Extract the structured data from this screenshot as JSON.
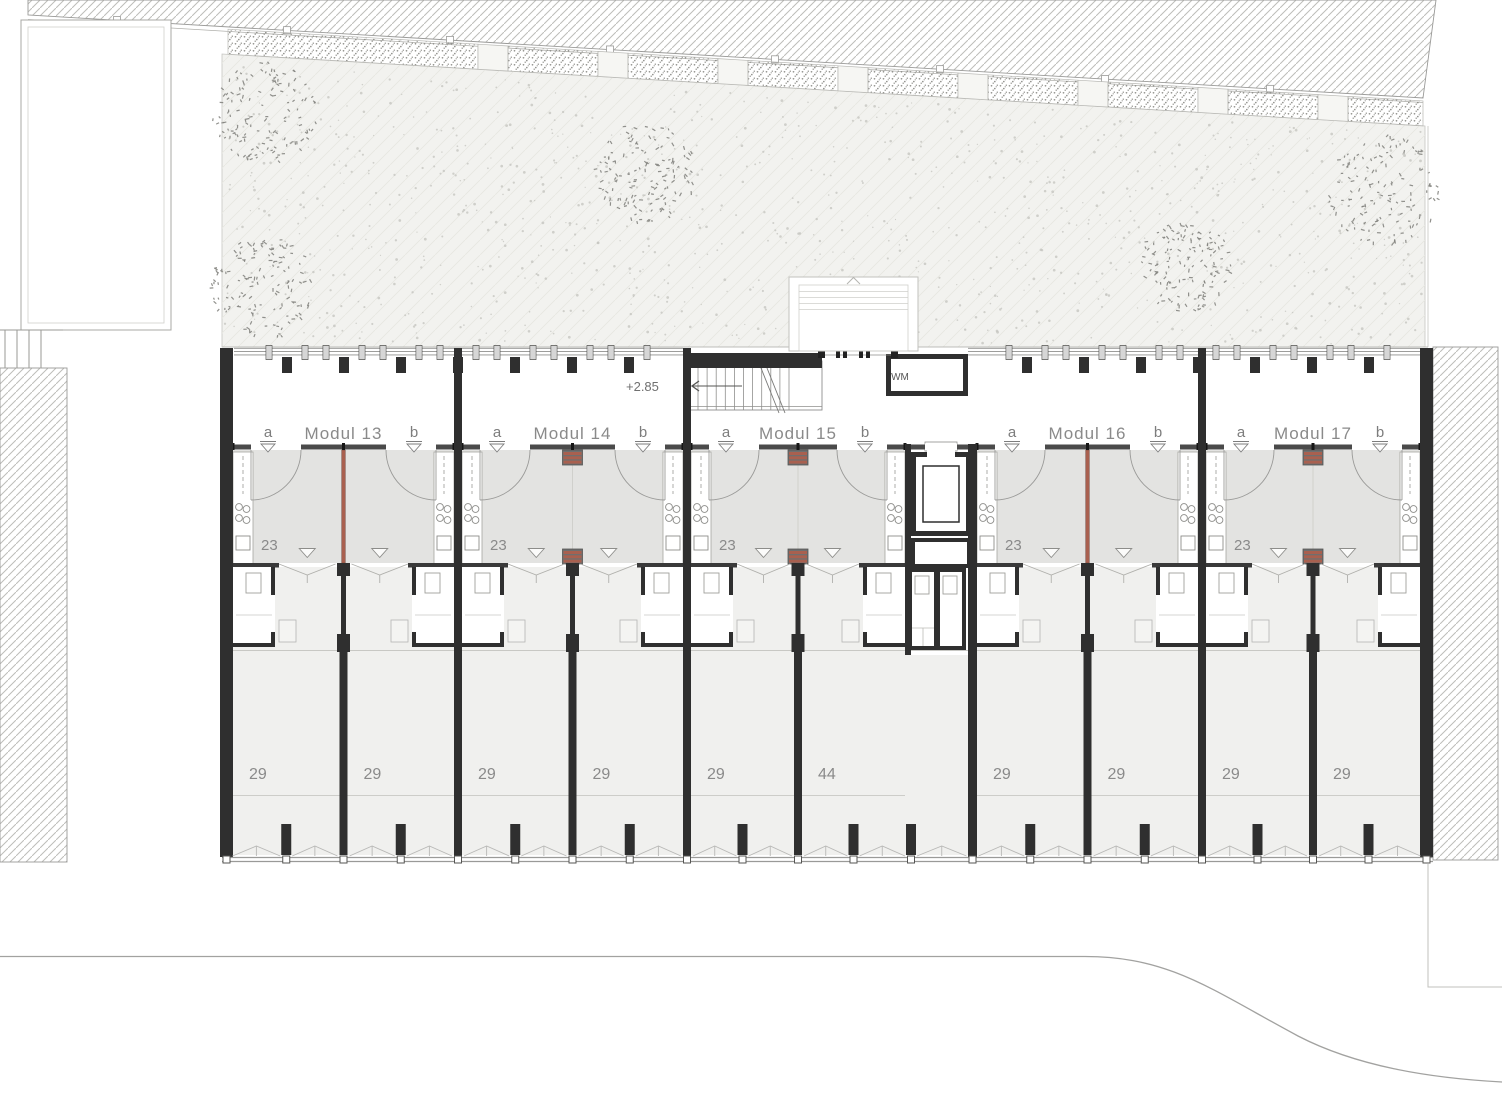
{
  "plan": {
    "level_label": "+2.85",
    "core": {
      "wm_label": "WM"
    },
    "modules": [
      {
        "name": "Modul 13",
        "marker_a": "a",
        "marker_b": "b",
        "upper_area": "23",
        "units": [
          {
            "area": "29"
          },
          {
            "area": "29"
          }
        ]
      },
      {
        "name": "Modul 14",
        "marker_a": "a",
        "marker_b": "b",
        "upper_area": "23",
        "units": [
          {
            "area": "29"
          },
          {
            "area": "29"
          }
        ]
      },
      {
        "name": "Modul 15",
        "marker_a": "a",
        "marker_b": "b",
        "upper_area": "23",
        "units": [
          {
            "area": "29"
          },
          {
            "area": "44"
          }
        ]
      },
      {
        "name": "Modul 16",
        "marker_a": "a",
        "marker_b": "b",
        "upper_area": "23",
        "units": [
          {
            "area": "29"
          },
          {
            "area": "29"
          }
        ]
      },
      {
        "name": "Modul 17",
        "marker_a": "a",
        "marker_b": "b",
        "upper_area": "23",
        "units": [
          {
            "area": "29"
          },
          {
            "area": "29"
          }
        ]
      }
    ],
    "colors": {
      "wall": "#2f2f2f",
      "front_wall": "#4a4a4a",
      "gray_room": "#e3e3e1",
      "room": "#f0f0ee",
      "accent_red": "#a9604f",
      "hatch_line": "#bdbdb9",
      "outline": "#9a9a98",
      "text": "#8a8a8a",
      "garden": "#f2f2ef"
    }
  }
}
